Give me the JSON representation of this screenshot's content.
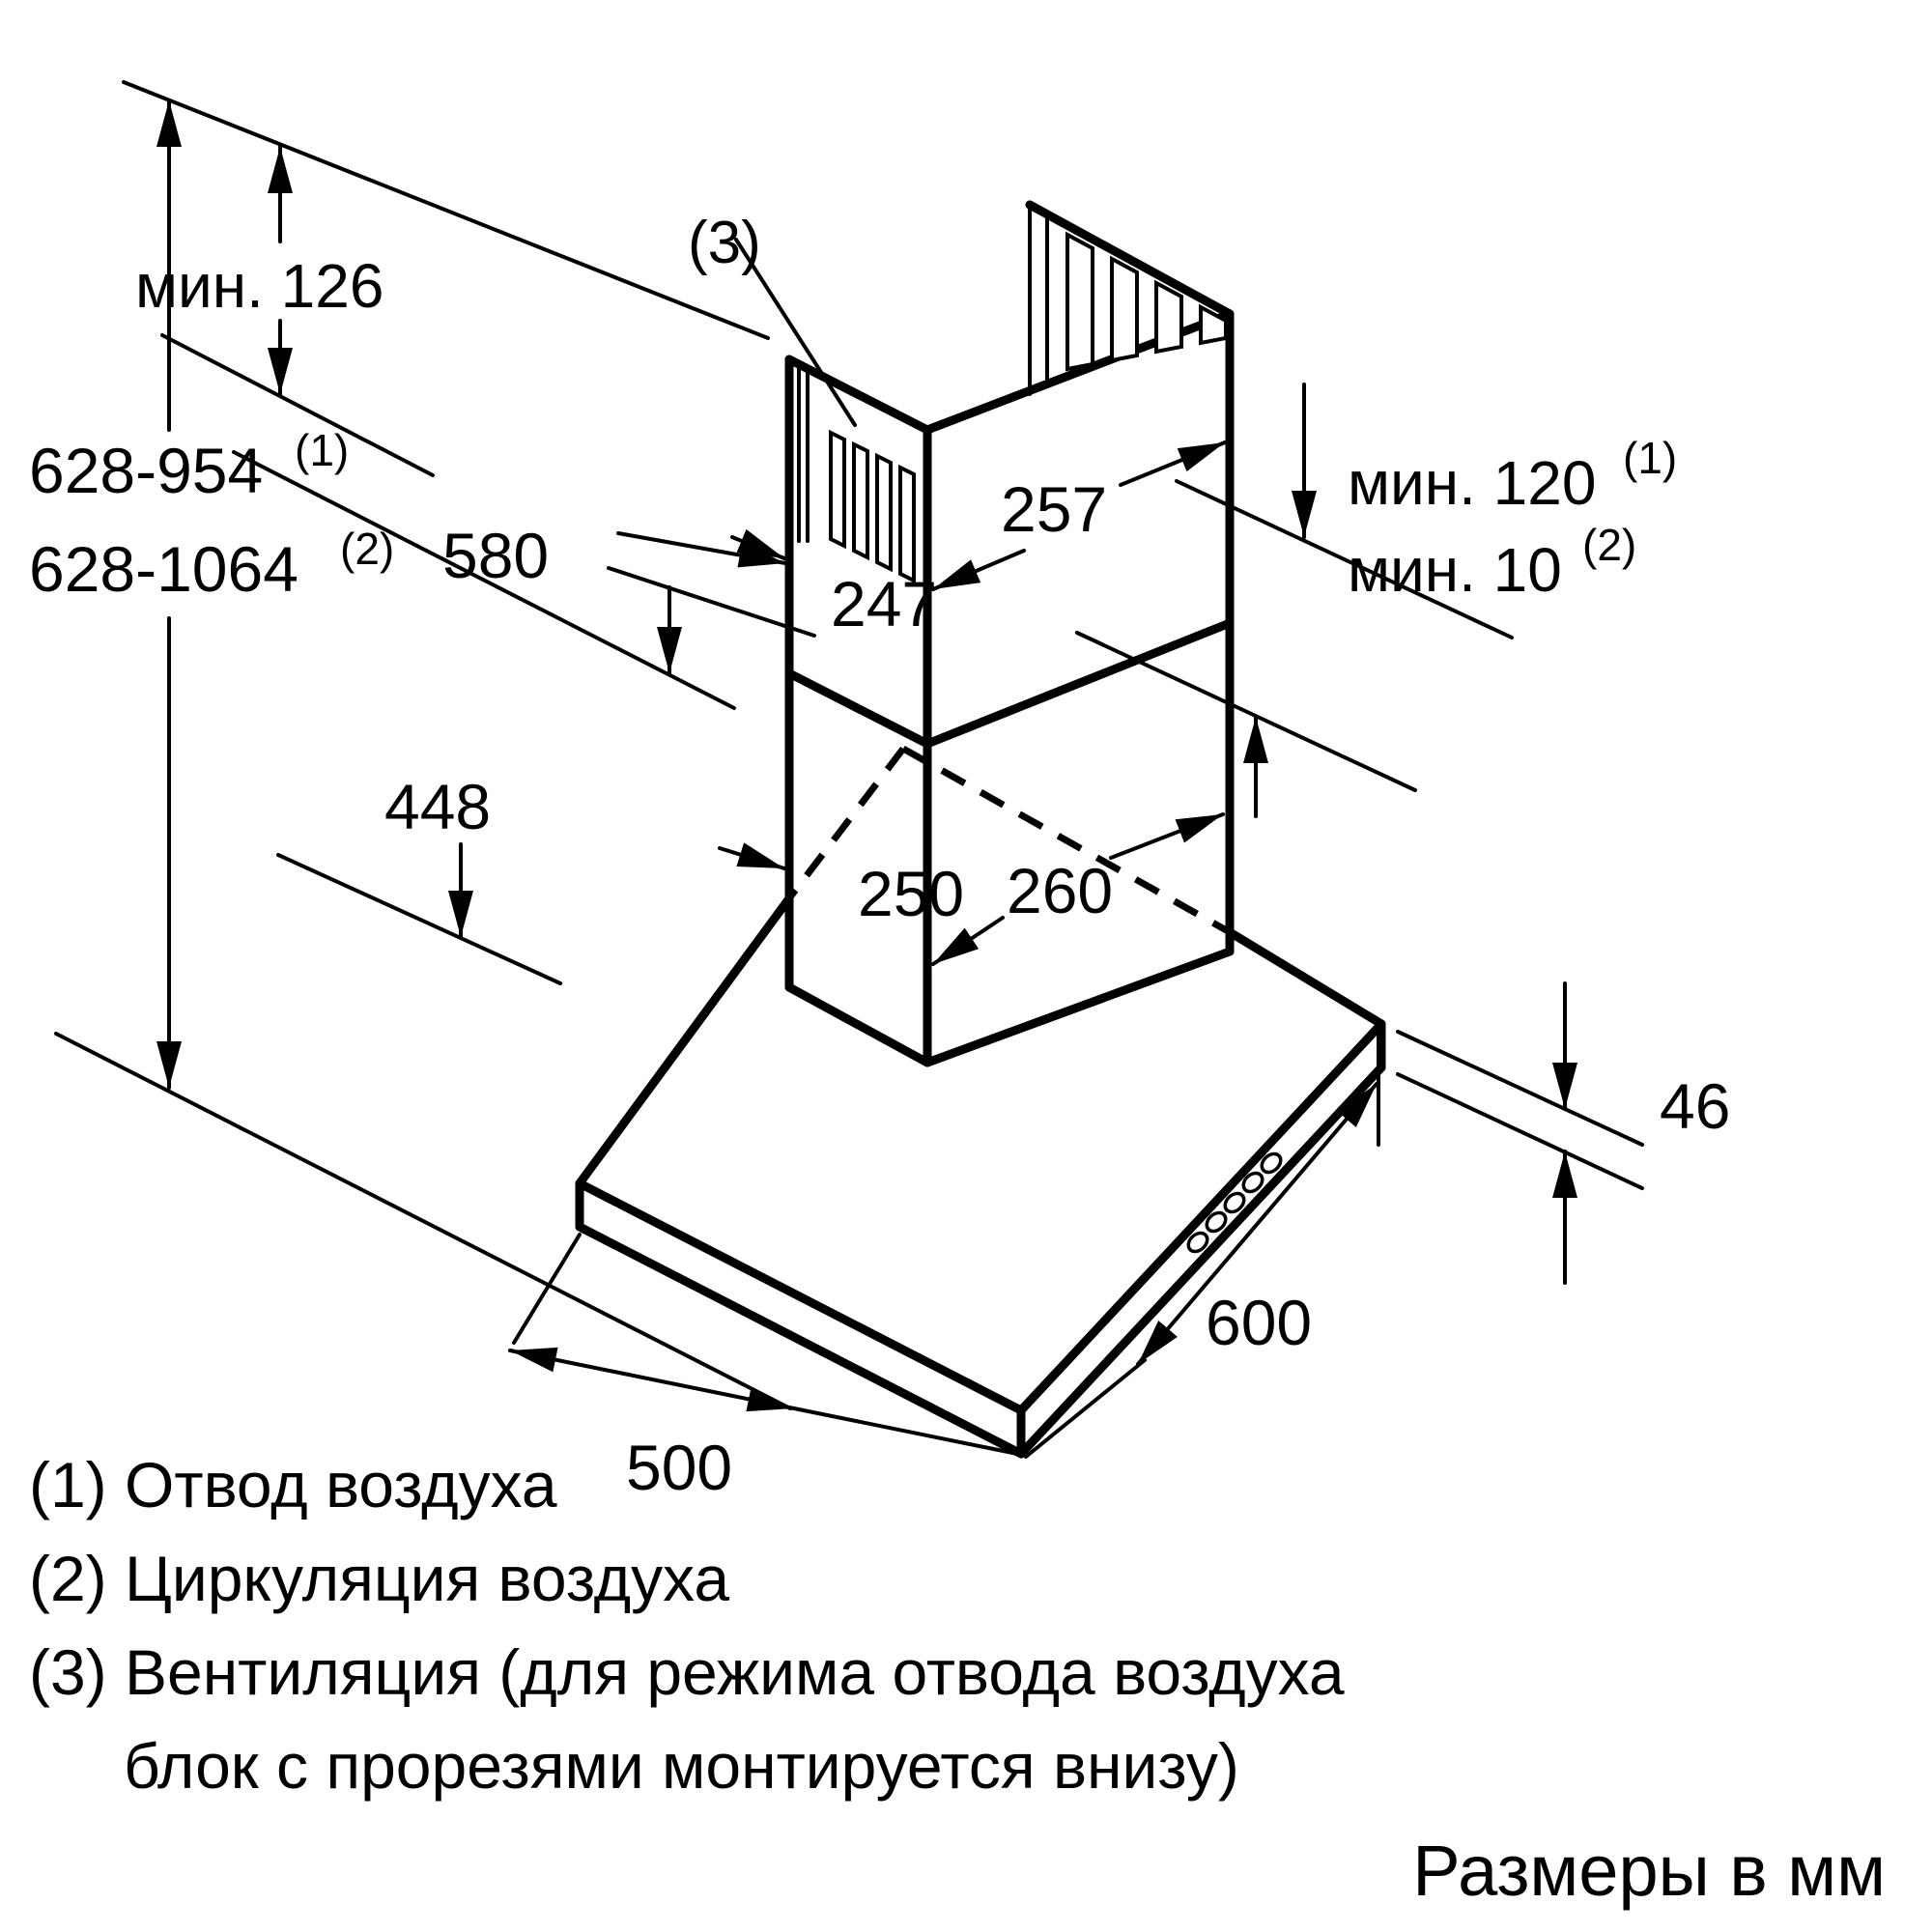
{
  "diagram": {
    "title": "Cooker hood installation dimensions",
    "dimensions": {
      "ceiling_min_clearance": "мин. 126",
      "total_height_duct": "628-954",
      "total_height_duct_ref": "(1)",
      "total_height_recirc": "628-1064",
      "total_height_recirc_ref": "(2)",
      "upper_chimney_height": "580",
      "lower_chimney_height": "448",
      "upper_chimney_front_width": "247",
      "upper_chimney_side_width": "257",
      "lower_chimney_front_width": "250",
      "lower_chimney_side_width": "260",
      "min_gap_duct": "мин. 120",
      "min_gap_duct_ref": "(1)",
      "min_gap_recirc": "мин. 10",
      "min_gap_recirc_ref": "(2)",
      "hood_body_height": "46",
      "hood_depth": "600",
      "hood_width": "500",
      "vent_callout": "(3)"
    },
    "legend": [
      "(1) Отвод воздуха",
      "(2) Циркуляция воздуха",
      "(3) Вентиляция (для режима отвода воздуха",
      "блок с прорезями монтируется внизу)"
    ],
    "footer": "Размеры в мм"
  }
}
